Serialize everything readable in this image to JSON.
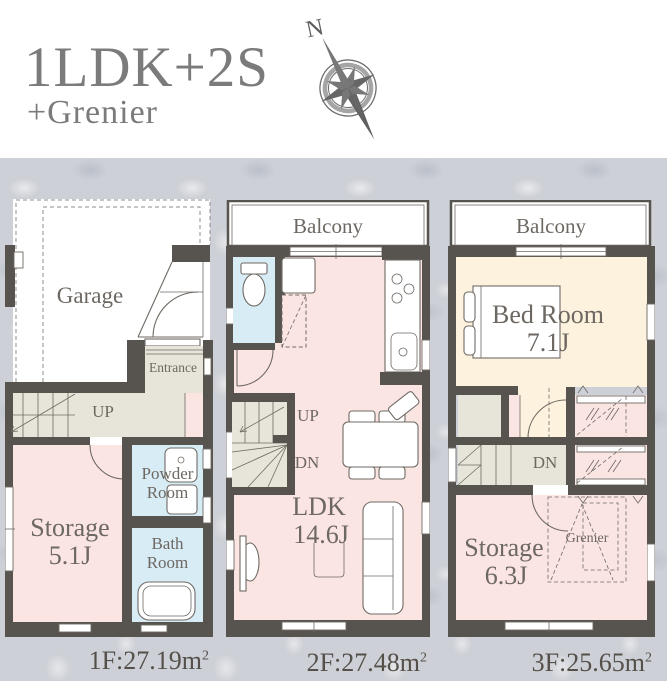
{
  "header": {
    "title": "1LDK+2S",
    "subtitle": "+Grenier",
    "compass_label": "N"
  },
  "palette": {
    "wall": "#57534e",
    "room_pink": "#fbe5e3",
    "room_blue": "#d8ecf6",
    "room_cream": "#fcf2de",
    "room_hall_gray": "#e7e5d9",
    "background_texture": "#cdd0d6",
    "title_text": "#7b7b7b",
    "plan_text": "#6e6862"
  },
  "floor1": {
    "rooms": {
      "garage": "Garage",
      "entrance": "Entrance",
      "stairs_up": "UP",
      "storage_name": "Storage",
      "storage_size": "5.1J",
      "powder_room": "Powder\nRoom",
      "bath_room": "Bath\nRoom"
    },
    "area_value": "1F:27.19",
    "area_unit": "m",
    "area_exponent": "2"
  },
  "floor2": {
    "rooms": {
      "balcony": "Balcony",
      "stairs_up": "UP",
      "stairs_down": "DN",
      "ldk_name": "LDK",
      "ldk_size": "14.6J"
    },
    "area_value": "2F:27.48",
    "area_unit": "m",
    "area_exponent": "2"
  },
  "floor3": {
    "rooms": {
      "balcony": "Balcony",
      "stairs_down": "DN",
      "bedroom_name": "Bed Room",
      "bedroom_size": "7.1J",
      "storage_name": "Storage",
      "storage_size": "6.3J",
      "grenier": "Grenier"
    },
    "area_value": "3F:25.65",
    "area_unit": "m",
    "area_exponent": "2"
  }
}
